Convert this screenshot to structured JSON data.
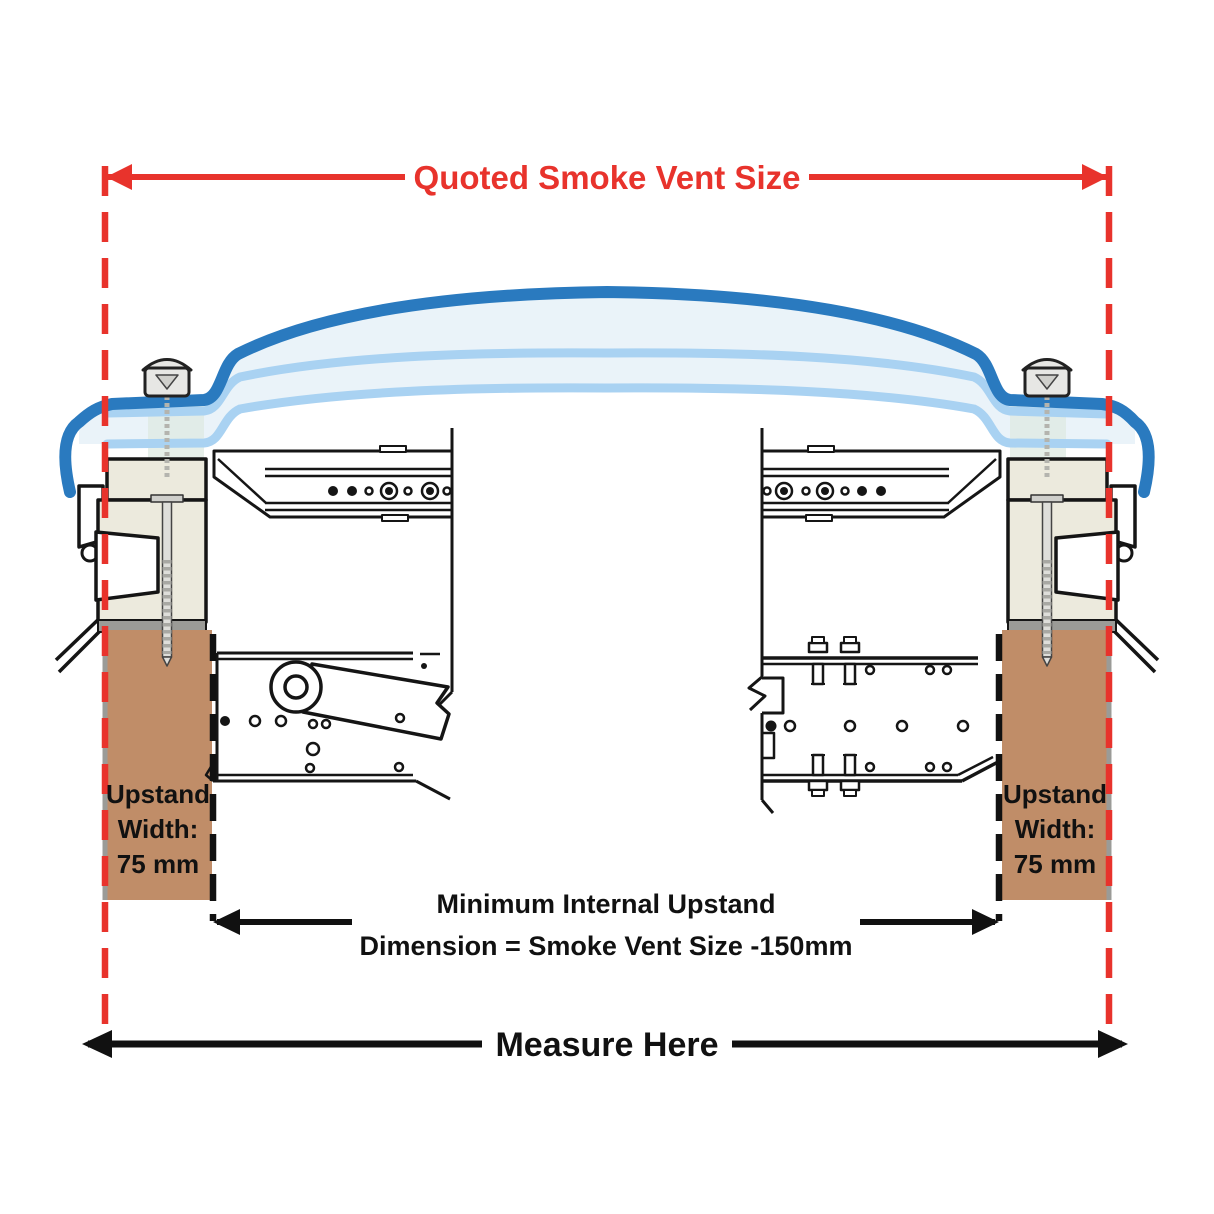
{
  "colors": {
    "dimension_red": "#e8332c",
    "upstand_brown": "#c08d68",
    "dome_blue_dark": "#2a7abf",
    "dome_blue_light": "#a9d2f2",
    "dome_fill": "#eaf3f9",
    "frame_cream": "#eceadd",
    "line_black": "#151515",
    "seal_gray": "#9b9b97"
  },
  "labels": {
    "quoted_size": "Quoted Smoke Vent Size",
    "measure_here": "Measure Here",
    "internal_dimension": {
      "line1": "Minimum Internal Upstand",
      "line2": "Dimension = Smoke Vent Size -150mm"
    },
    "upstand_left": {
      "line1": "Upstand",
      "line2": "Width:",
      "line3": "75 mm"
    },
    "upstand_right": {
      "line1": "Upstand",
      "line2": "Width:",
      "line3": "75 mm"
    }
  }
}
